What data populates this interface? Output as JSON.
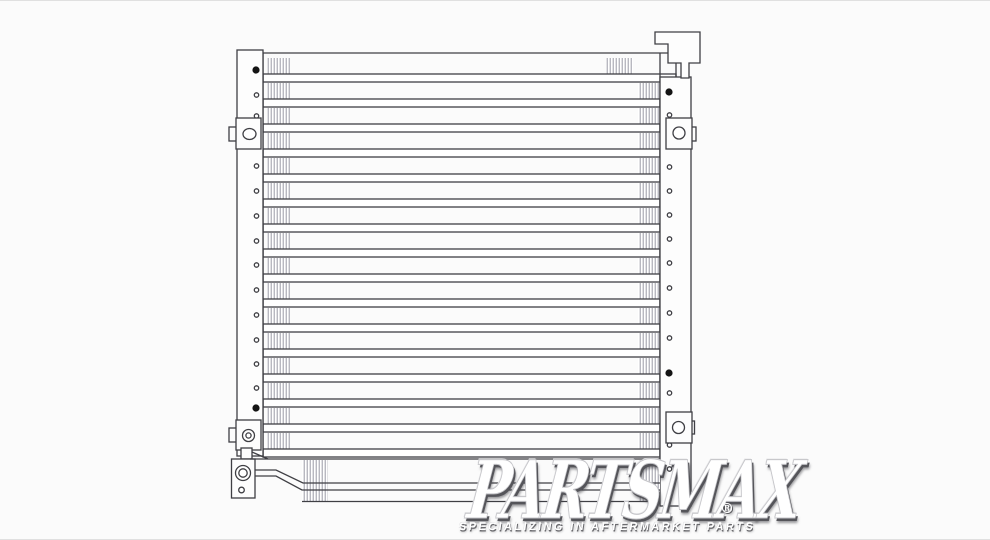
{
  "page": {
    "background": "#fbfbfb",
    "edge_line_color": "#e0e0e0"
  },
  "watermark": {
    "brand": "PARTSMAX",
    "registered_mark": "®",
    "tagline": "SPECIALIZING IN AFTERMARKET PARTS",
    "text_color": "#ffffff",
    "shadow_color": "#55555a"
  },
  "drawing": {
    "subject": "ac-condenser-line-art",
    "line_color": "#3f3f44",
    "fin_color": "#9a9aa6",
    "fill_color": "#fdfdfd",
    "dot_color": "#141414",
    "core": {
      "rows": 16
    },
    "left_tank": {
      "holes_y": [
        95,
        116,
        166,
        191,
        216,
        241,
        265,
        290,
        315,
        340,
        364,
        388
      ],
      "solid_dots_y": [
        70,
        408
      ]
    },
    "right_tank": {
      "holes_y": [
        115,
        167,
        191,
        215,
        239,
        263,
        288,
        313,
        338,
        393,
        445,
        469,
        497
      ],
      "solid_dots_y": [
        92,
        373
      ]
    }
  }
}
